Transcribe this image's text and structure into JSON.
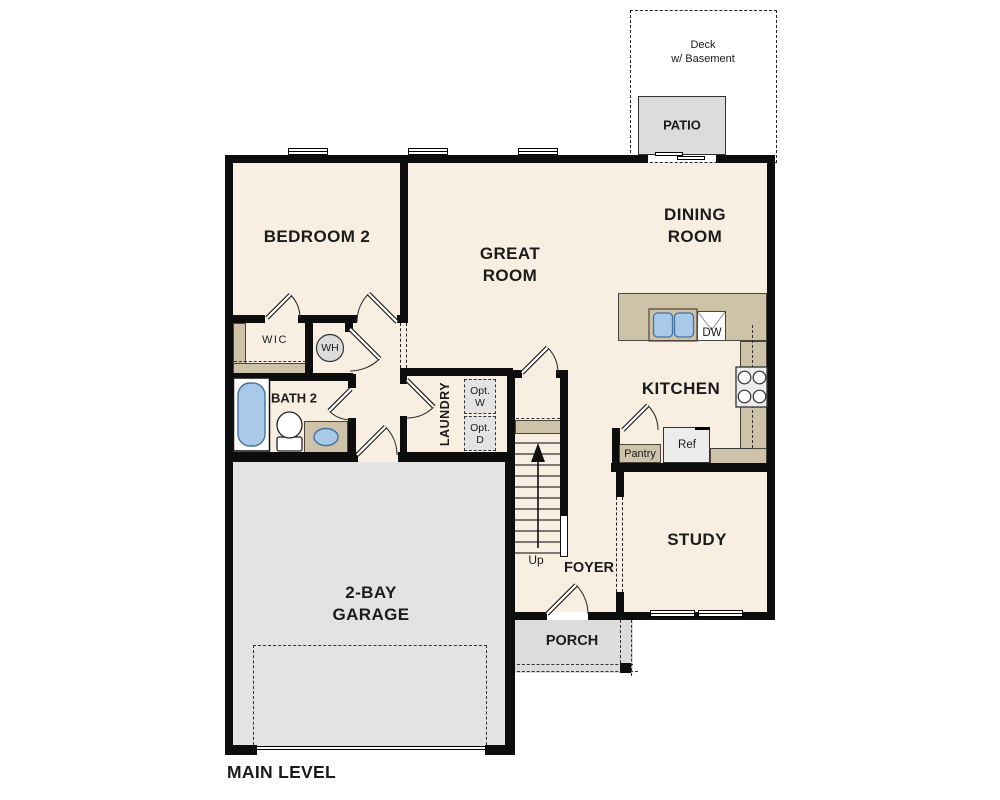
{
  "colors": {
    "floor": "#f8efe2",
    "wall": "#0d0d0d",
    "counter": "#cec2a8",
    "garage": "#e3e3e3",
    "porch": "#dcdcdc",
    "patio": "#dcdcdc",
    "fixture_blue": "#a9c9e9",
    "fixture_blue_border": "#44729f",
    "appliance": "#ececec",
    "optional_fill": "#e3e3e3",
    "label": "#1b1b1b"
  },
  "labels": {
    "bedroom2": "BEDROOM 2",
    "great_room": "GREAT\nROOM",
    "dining_room": "DINING\nROOM",
    "kitchen": "KITCHEN",
    "study": "STUDY",
    "garage": "2-BAY\nGARAGE",
    "foyer": "FOYER",
    "porch": "PORCH",
    "patio": "PATIO",
    "deck": "Deck\nw/ Basement",
    "laundry": "LAUNDRY",
    "bath2": "BATH 2",
    "wic": "WIC",
    "water_heater": "WH",
    "pantry": "Pantry",
    "refrigerator": "Ref",
    "dishwasher": "DW",
    "stairs_direction": "Up",
    "optional_washer": "Opt.\nW",
    "optional_dryer": "Opt.\nD",
    "plan_title": "MAIN LEVEL"
  }
}
